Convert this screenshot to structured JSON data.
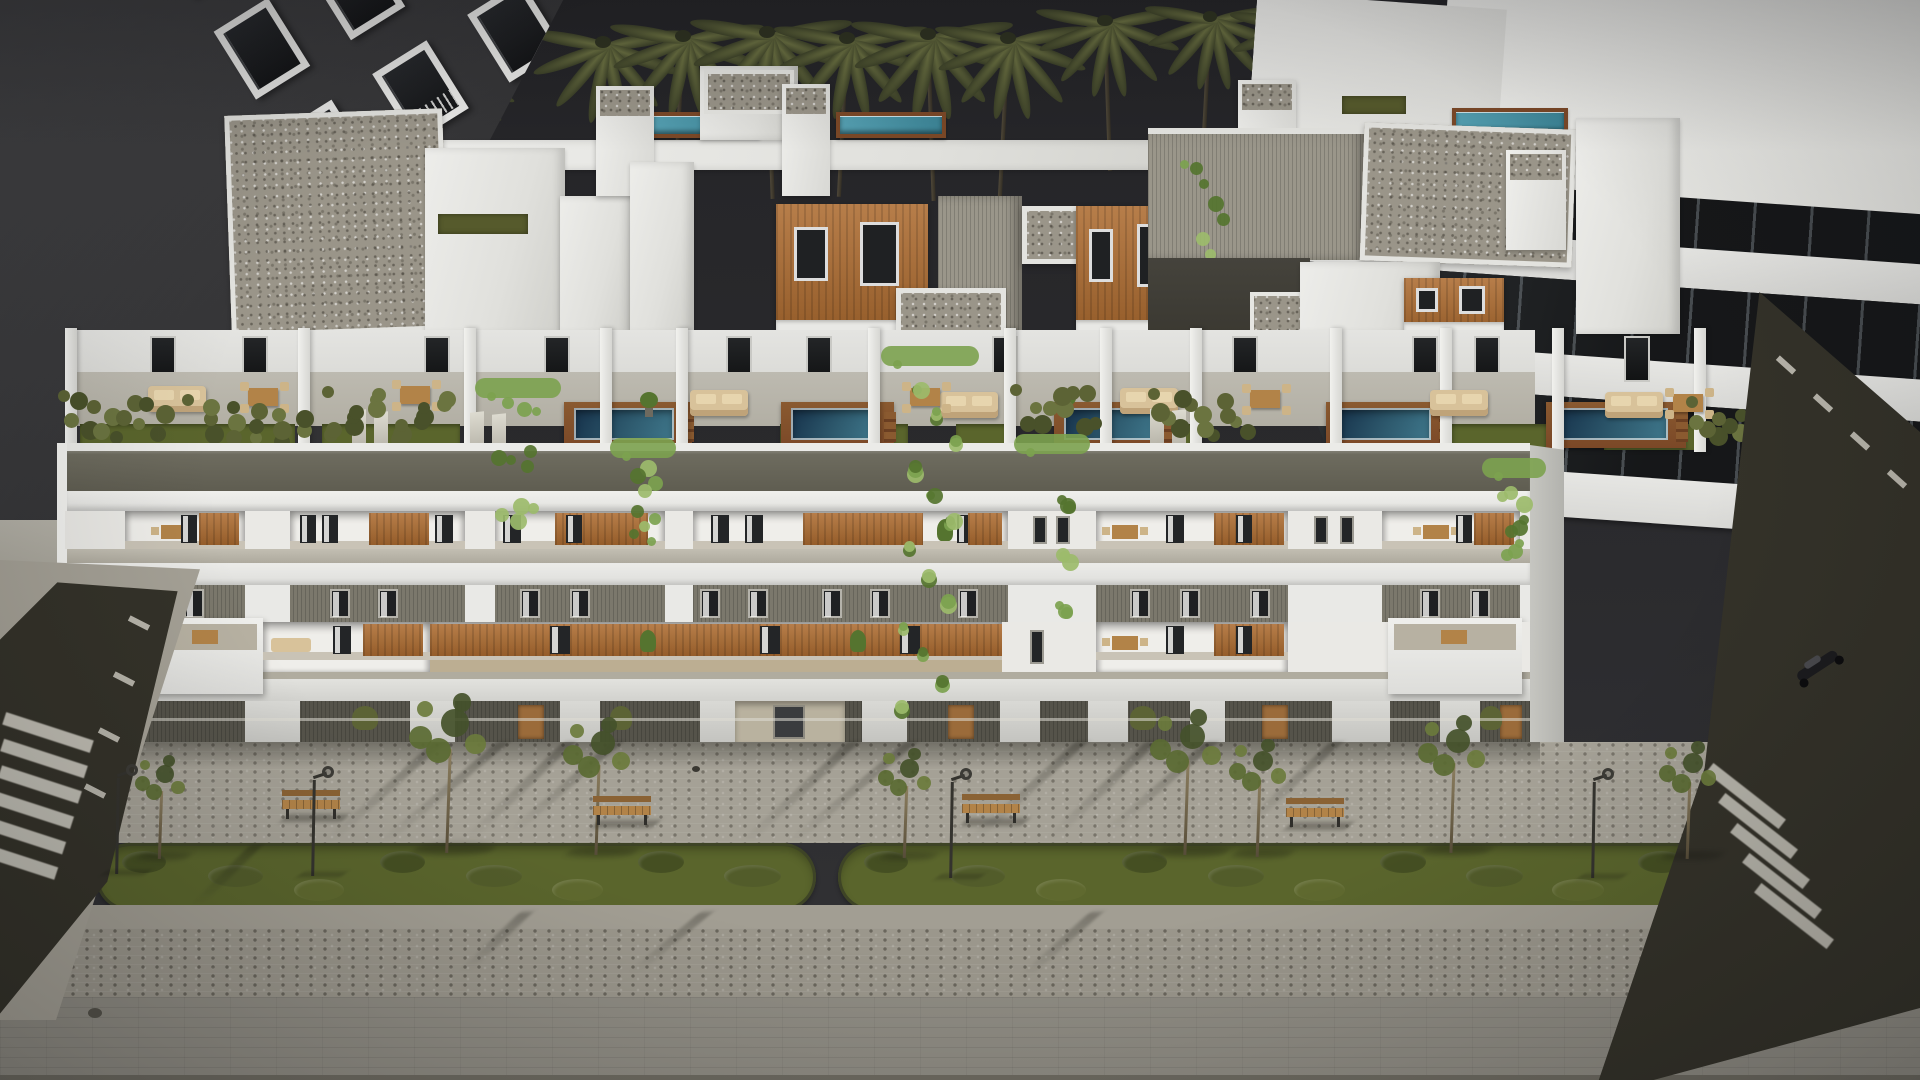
{
  "scene": {
    "type": "3d-architectural-render",
    "description": "Dusk aerial view of a long modern white apartment building with penthouse level, rooftop terraces with plunge pools and hedges, two balcony floors with wood panels and cascading ivy, ground floor, and a paved promenade with two landscaped median strips, benches, lamps and young trees; dark neighbor building left, white glazed building right, palm trees behind, side streets with crosswalks and a parked scooter.",
    "time_of_day": "dusk",
    "inventory": {
      "palm_trees": 15,
      "terrace_pools": 5,
      "upper_roof_pools": 3,
      "green_median_strips": 2,
      "street_trees": 8,
      "benches": 4,
      "street_lamps": 4,
      "crosswalks": 2,
      "scooters": 1,
      "residential_floors_visible": 4
    }
  },
  "palette": {
    "sky": "#2c2c2f",
    "sky_top": "#242427",
    "white_bright": "#f2f2ef",
    "white": "#e6e6e3",
    "white_dim": "#d9d9d6",
    "white_shade": "#c7c7c3",
    "gravel": "#9a9589",
    "ribbed": "#97938a",
    "fascia_top": "#6f6d60",
    "fascia_bot": "#5f5d51",
    "gray_band": "#7b786c",
    "ledge": "#b7b3a7",
    "terrace_floor": "#b2afa4",
    "wood_panel": "#ad6c31",
    "wood_deck": "#7b4827",
    "door_wood": "#9b6b3a",
    "pool_deep": "#16314a",
    "pool_mid": "#2e5a6e",
    "pool_light": "#55a0b2",
    "grass_roof": "#565a2c",
    "hedge": "#5c6335",
    "hedge_dark": "#49512a",
    "ivy": "#7ca24f",
    "ivy_dark": "#55742f",
    "ivy_light": "#9cbb6b",
    "lawn": "#5a652c",
    "lawn_dark": "#454f22",
    "pave": "#a5a196",
    "pave_dark": "#97938a",
    "road": "#908d84",
    "asphalt": "#343229",
    "stripe_white": "#d9d6cc",
    "beige": "#d8c29a",
    "beige_wood": "#b28348",
    "dark_building": "#3a3a3c",
    "glass": "#1d1f21",
    "frame_white": "#e9e9e7",
    "metal_dark": "#2f2e2a",
    "shadow": "rgba(22,22,18,0.3)"
  },
  "palms": [
    [
      318,
      58,
      0.85
    ],
    [
      468,
      86,
      0.6
    ],
    [
      603,
      46,
      1.0
    ],
    [
      683,
      40,
      1.0
    ],
    [
      767,
      36,
      1.05
    ],
    [
      847,
      42,
      1.0
    ],
    [
      928,
      38,
      1.05
    ],
    [
      1008,
      42,
      1.0
    ],
    [
      1105,
      24,
      0.95
    ],
    [
      1210,
      20,
      0.9
    ],
    [
      1295,
      26,
      0.9
    ],
    [
      1385,
      30,
      0.85
    ],
    [
      1492,
      22,
      0.85
    ],
    [
      1603,
      16,
      0.8
    ],
    [
      1697,
      20,
      0.8
    ]
  ],
  "left_building": {
    "w": 640,
    "h": 660,
    "clip": "polygon(0 0, 88% 0, 34% 100%, 0 100%)",
    "grid": {
      "cols": 4,
      "rows": 5,
      "cw": 64,
      "ch": 80,
      "gx": 48,
      "gy": 40,
      "rot": -32,
      "ox": 150,
      "oy": -70
    },
    "back_block": [
      0,
      0,
      215,
      320
    ],
    "base_wall": [
      0,
      520,
      190,
      90
    ]
  },
  "right_building": {
    "x": 1235,
    "y": -24,
    "w": 700,
    "h": 700,
    "rot": 4,
    "clip": "polygon(0 0,100% 0,100% 100%,30% 100%,0 42%)",
    "roof": [
      190,
      0,
      510,
      215
    ],
    "gable": [
      0,
      40,
      250,
      160
    ],
    "bands": [
      [
        150,
        45,
        "white"
      ],
      [
        195,
        70,
        "glass"
      ],
      [
        265,
        40,
        "white"
      ],
      [
        305,
        75,
        "glass"
      ],
      [
        380,
        42,
        "white"
      ],
      [
        422,
        75,
        "glass"
      ],
      [
        497,
        45,
        "white"
      ]
    ]
  },
  "penthouse": [
    {
      "t": "wparapet",
      "x": 430,
      "y": 140,
      "w": 830,
      "h": 30
    },
    {
      "t": "pool",
      "x": 648,
      "y": 112,
      "w": 112,
      "h": 26
    },
    {
      "t": "pool",
      "x": 836,
      "y": 112,
      "w": 110,
      "h": 26
    },
    {
      "t": "pool",
      "x": 1452,
      "y": 108,
      "w": 116,
      "h": 28
    },
    {
      "t": "grass",
      "x": 1342,
      "y": 96,
      "w": 64,
      "h": 18
    },
    {
      "t": "gravel",
      "x": 228,
      "y": 112,
      "w": 218,
      "h": 222,
      "r": -2
    },
    {
      "t": "white",
      "x": 425,
      "y": 148,
      "w": 140,
      "h": 186
    },
    {
      "t": "grass",
      "x": 438,
      "y": 214,
      "w": 90,
      "h": 20
    },
    {
      "t": "white",
      "x": 560,
      "y": 196,
      "w": 72,
      "h": 138
    },
    {
      "t": "tower",
      "x": 596,
      "y": 86,
      "w": 58,
      "h": 110
    },
    {
      "t": "white",
      "x": 630,
      "y": 162,
      "w": 64,
      "h": 172
    },
    {
      "t": "white",
      "x": 700,
      "y": 66,
      "w": 98,
      "h": 74
    },
    {
      "t": "gravelcap",
      "x": 704,
      "y": 70,
      "w": 90,
      "h": 44
    },
    {
      "t": "tower",
      "x": 782,
      "y": 84,
      "w": 48,
      "h": 112
    },
    {
      "t": "wood",
      "x": 776,
      "y": 204,
      "w": 152,
      "h": 128
    },
    {
      "t": "ribbed",
      "x": 938,
      "y": 196,
      "w": 84,
      "h": 140
    },
    {
      "t": "gravel",
      "x": 896,
      "y": 288,
      "w": 110,
      "h": 48,
      "r": 0
    },
    {
      "t": "gravel",
      "x": 1022,
      "y": 206,
      "w": 112,
      "h": 58,
      "r": 0
    },
    {
      "t": "wood",
      "x": 1076,
      "y": 206,
      "w": 110,
      "h": 126
    },
    {
      "t": "white",
      "x": 1188,
      "y": 152,
      "w": 72,
      "h": 182
    },
    {
      "t": "tower",
      "x": 1238,
      "y": 80,
      "w": 58,
      "h": 112
    },
    {
      "t": "ribbedwall",
      "x": 1148,
      "y": 128,
      "w": 218,
      "h": 132
    },
    {
      "t": "ivy",
      "x": 1180,
      "y": 160,
      "w": 54,
      "h": 190
    },
    {
      "t": "darkrec",
      "x": 1148,
      "y": 258,
      "w": 162,
      "h": 96
    },
    {
      "t": "gravelcap",
      "x": 1250,
      "y": 292,
      "w": 72,
      "h": 50
    },
    {
      "t": "gravel",
      "x": 1362,
      "y": 126,
      "w": 212,
      "h": 138,
      "r": 2
    },
    {
      "t": "white",
      "x": 1300,
      "y": 262,
      "w": 140,
      "h": 72
    },
    {
      "t": "wood",
      "x": 1404,
      "y": 278,
      "w": 100,
      "h": 56
    },
    {
      "t": "white",
      "x": 1576,
      "y": 118,
      "w": 104,
      "h": 216
    },
    {
      "t": "tower",
      "x": 1506,
      "y": 150,
      "w": 60,
      "h": 100
    }
  ],
  "terrace": {
    "backwall": [
      65,
      330,
      1470,
      62
    ],
    "floor": [
      65,
      372,
      1470,
      54
    ],
    "doors_x": [
      150,
      242,
      424,
      544,
      726,
      806,
      992,
      1232,
      1412,
      1474,
      1624
    ],
    "dividers_x": [
      65,
      298,
      464,
      600,
      676,
      868,
      1004,
      1100,
      1190,
      1330,
      1440,
      1552,
      1694
    ],
    "grass": [
      [
        80,
        215
      ],
      [
        322,
        138
      ],
      [
        610,
        66
      ],
      [
        780,
        128
      ],
      [
        956,
        52
      ],
      [
        1108,
        84
      ],
      [
        1446,
        118
      ],
      [
        1604,
        96
      ]
    ],
    "pools": [
      [
        578,
        100
      ],
      [
        795,
        85
      ],
      [
        1068,
        92
      ],
      [
        1340,
        95
      ],
      [
        1560,
        112
      ]
    ],
    "sofas": [
      [
        148,
        386
      ],
      [
        690,
        390
      ],
      [
        940,
        392
      ],
      [
        1120,
        388
      ],
      [
        1430,
        390
      ],
      [
        1605,
        392
      ]
    ],
    "dining": [
      [
        240,
        380
      ],
      [
        392,
        378
      ],
      [
        902,
        380
      ],
      [
        1242,
        382
      ],
      [
        1665,
        386
      ]
    ],
    "loungers": [
      [
        352,
        410
      ],
      [
        1150,
        408
      ],
      [
        470,
        412
      ]
    ],
    "pot_plants": [
      [
        640,
        392
      ],
      [
        1058,
        390
      ]
    ],
    "hedges": [
      [
        58,
        390,
        125,
        60
      ],
      [
        182,
        394,
        132,
        58
      ],
      [
        322,
        386,
        152,
        64
      ],
      [
        1010,
        384,
        98,
        62
      ],
      [
        1148,
        388,
        118,
        60
      ],
      [
        1686,
        396,
        72,
        50
      ]
    ]
  },
  "facade": {
    "x": 65,
    "w": 1465,
    "bands": [
      {
        "name": "parapet-cap",
        "y": 443,
        "h": 8,
        "css": "background:#ebebe8;"
      },
      {
        "name": "fascia",
        "y": 451,
        "h": 40,
        "css": "background:linear-gradient(180deg,#6f6d60,#5f5d51);box-shadow:inset 0 2px 2px rgba(255,255,255,0.12);"
      },
      {
        "name": "upper-slab",
        "y": 491,
        "h": 20,
        "css": "background:linear-gradient(180deg,#f0f0ed,#e2e2df);box-shadow:inset 0 -4px 5px rgba(0,0,0,0.14);"
      },
      {
        "name": "upper-balcony-row",
        "y": 511,
        "h": 38,
        "css": "background:#efeeea;"
      },
      {
        "name": "ledge",
        "y": 549,
        "h": 14,
        "css": "background:linear-gradient(180deg,#c2beb2,#aeaa9e);"
      },
      {
        "name": "mid-slab",
        "y": 563,
        "h": 22,
        "css": "background:linear-gradient(180deg,#ecece9,#dededb);box-shadow:inset 0 -3px 4px rgba(0,0,0,0.12);"
      },
      {
        "name": "gray-band",
        "y": 585,
        "h": 37,
        "css": "background:#7b786c;"
      },
      {
        "name": "lower-balcony-row",
        "y": 622,
        "h": 50,
        "css": "background:#efeeea;"
      },
      {
        "name": "lower-ledge",
        "y": 672,
        "h": 7,
        "css": "background:#b0ac9f;"
      },
      {
        "name": "ground-white",
        "y": 679,
        "h": 22,
        "css": "background:linear-gradient(180deg,#e2e2de,#d2d2ce);"
      },
      {
        "name": "ground-dark",
        "y": 701,
        "h": 41,
        "css": ""
      },
      {
        "name": "base-shadow",
        "y": 742,
        "h": 16,
        "css": "background:linear-gradient(180deg,rgba(20,20,16,0.42),rgba(20,20,16,0));"
      }
    ],
    "upper_modules": [
      {
        "x": 65,
        "w": 60,
        "t": "wall"
      },
      {
        "x": 125,
        "w": 120,
        "t": "recess",
        "c": "dining"
      },
      {
        "x": 245,
        "w": 45,
        "t": "wall"
      },
      {
        "x": 290,
        "w": 175,
        "t": "recess",
        "c": "mix"
      },
      {
        "x": 465,
        "w": 30,
        "t": "wall"
      },
      {
        "x": 495,
        "w": 170,
        "t": "recess",
        "c": "orange"
      },
      {
        "x": 665,
        "w": 28,
        "t": "wall"
      },
      {
        "x": 693,
        "w": 315,
        "t": "recess",
        "c": "long"
      },
      {
        "x": 1008,
        "w": 88,
        "t": "wall",
        "win": true
      },
      {
        "x": 1096,
        "w": 192,
        "t": "recess",
        "c": "mix2"
      },
      {
        "x": 1288,
        "w": 94,
        "t": "wall",
        "win": true
      },
      {
        "x": 1382,
        "w": 138,
        "t": "recess",
        "c": "dining"
      },
      {
        "x": 1520,
        "w": 10,
        "t": "wall"
      }
    ],
    "lower_modules": [
      {
        "x": 65,
        "w": 80,
        "t": "wall"
      },
      {
        "x": 145,
        "w": 118,
        "t": "box",
        "c": "dining"
      },
      {
        "x": 263,
        "w": 167,
        "t": "recess",
        "c": "sofa"
      },
      {
        "x": 430,
        "w": 572,
        "t": "recess",
        "c": "longwood"
      },
      {
        "x": 1002,
        "w": 94,
        "t": "wall",
        "win": true
      },
      {
        "x": 1096,
        "w": 192,
        "t": "recess",
        "c": "mix2"
      },
      {
        "x": 1288,
        "w": 100,
        "t": "wall"
      },
      {
        "x": 1388,
        "w": 134,
        "t": "box",
        "c": "dining"
      },
      {
        "x": 1522,
        "w": 8,
        "t": "wall"
      }
    ],
    "gray_windows_x": [
      132,
      184,
      330,
      378,
      520,
      570,
      700,
      748,
      822,
      870,
      958,
      1130,
      1180,
      1250,
      1420,
      1470
    ],
    "ground_piers": [
      [
        65,
        70
      ],
      [
        245,
        55
      ],
      [
        410,
        45
      ],
      [
        560,
        40
      ],
      [
        700,
        45
      ],
      [
        862,
        45
      ],
      [
        1000,
        40
      ],
      [
        1088,
        40
      ],
      [
        1190,
        35
      ],
      [
        1332,
        58
      ],
      [
        1440,
        40
      ]
    ],
    "ground_doors": [
      [
        518,
        26
      ],
      [
        948,
        26
      ],
      [
        1262,
        26
      ],
      [
        1500,
        22
      ]
    ],
    "ground_entry": [
      735,
      110
    ],
    "ground_shrubs": [
      [
        352,
        26
      ],
      [
        610,
        22
      ],
      [
        1130,
        26
      ],
      [
        1480,
        22
      ]
    ],
    "ivy_columns": [
      [
        487,
        392,
        62,
        168
      ],
      [
        622,
        452,
        42,
        112
      ],
      [
        893,
        360,
        74,
        360
      ],
      [
        1026,
        448,
        52,
        176
      ],
      [
        1494,
        472,
        40,
        96
      ]
    ]
  },
  "street": {
    "upper_walk": [
      0,
      742,
      1920,
      101
    ],
    "smooth_band": [
      0,
      905,
      1920,
      23
    ],
    "speckle_band": [
      0,
      928,
      1920,
      69
    ],
    "road": [
      0,
      997,
      1920,
      83
    ],
    "bottom_edge": [
      0,
      1075,
      1920,
      5
    ],
    "strips": [
      [
        96,
        843,
        720,
        68
      ],
      [
        838,
        843,
        868,
        68
      ]
    ],
    "trees": [
      [
        160,
        858,
        0.75
      ],
      [
        448,
        852,
        1.15
      ],
      [
        597,
        855,
        1.0
      ],
      [
        905,
        858,
        0.8
      ],
      [
        1186,
        854,
        1.05
      ],
      [
        1258,
        856,
        0.85
      ],
      [
        1452,
        853,
        1.0
      ],
      [
        1688,
        858,
        0.85
      ]
    ],
    "benches": [
      [
        282,
        790
      ],
      [
        593,
        796
      ],
      [
        962,
        794
      ],
      [
        1286,
        798
      ]
    ],
    "lamps": [
      [
        116,
        872
      ],
      [
        312,
        874
      ],
      [
        950,
        876
      ],
      [
        1592,
        876
      ]
    ],
    "drain": [
      692,
      766
    ],
    "manhole": [
      88,
      1008
    ],
    "shadow_streaks": [
      [
        433,
        742,
        98,
        -48
      ],
      [
        497,
        742,
        100,
        -50
      ],
      [
        563,
        742,
        96,
        -46
      ],
      [
        610,
        742,
        90,
        -49
      ],
      [
        847,
        742,
        100,
        -47
      ],
      [
        905,
        742,
        100,
        -50
      ],
      [
        1075,
        742,
        98,
        -48
      ],
      [
        1145,
        742,
        95,
        -46
      ],
      [
        1205,
        742,
        90,
        -49
      ],
      [
        1330,
        742,
        85,
        -47
      ],
      [
        250,
        845,
        60,
        -45
      ],
      [
        700,
        912,
        60,
        -50
      ],
      [
        1090,
        912,
        64,
        -48
      ],
      [
        520,
        912,
        58,
        -46
      ]
    ]
  },
  "left_street": {
    "sidewalk": {
      "x": 0,
      "y": 560,
      "w": 200,
      "h": 460,
      "clip": "polygon(0 0,100% 2%,28% 100%,0 100%)"
    },
    "asphalt": {
      "x": 0,
      "y": 578,
      "w": 185,
      "h": 440,
      "clip": "polygon(31% 1%,96% 3%,58% 69%,0 99%,0 14%)"
    },
    "zebra": [
      [
        2,
        148,
        92
      ],
      [
        0,
        174,
        88
      ],
      [
        -2,
        200,
        84
      ],
      [
        -6,
        226,
        80
      ],
      [
        -10,
        252,
        76
      ],
      [
        -14,
        278,
        72
      ]
    ],
    "dashes": [
      [
        136,
        34
      ],
      [
        121,
        90
      ],
      [
        106,
        146
      ],
      [
        92,
        202
      ]
    ]
  },
  "right_street": {
    "asphalt": {
      "x": 1555,
      "y": 280,
      "w": 365,
      "h": 800,
      "clip": "polygon(56% 1.5%,100% 19%,100% 91%,27% 100%,12% 100%,41% 61%)"
    },
    "zebra": [
      [
        145,
        510
      ],
      [
        157,
        540
      ],
      [
        169,
        570
      ],
      [
        181,
        600
      ],
      [
        193,
        630
      ]
    ],
    "dashes": [
      [
        220,
        82
      ],
      [
        257,
        120
      ],
      [
        294,
        158
      ],
      [
        331,
        196
      ]
    ],
    "scooter": {
      "x": 235,
      "y": 372
    }
  }
}
